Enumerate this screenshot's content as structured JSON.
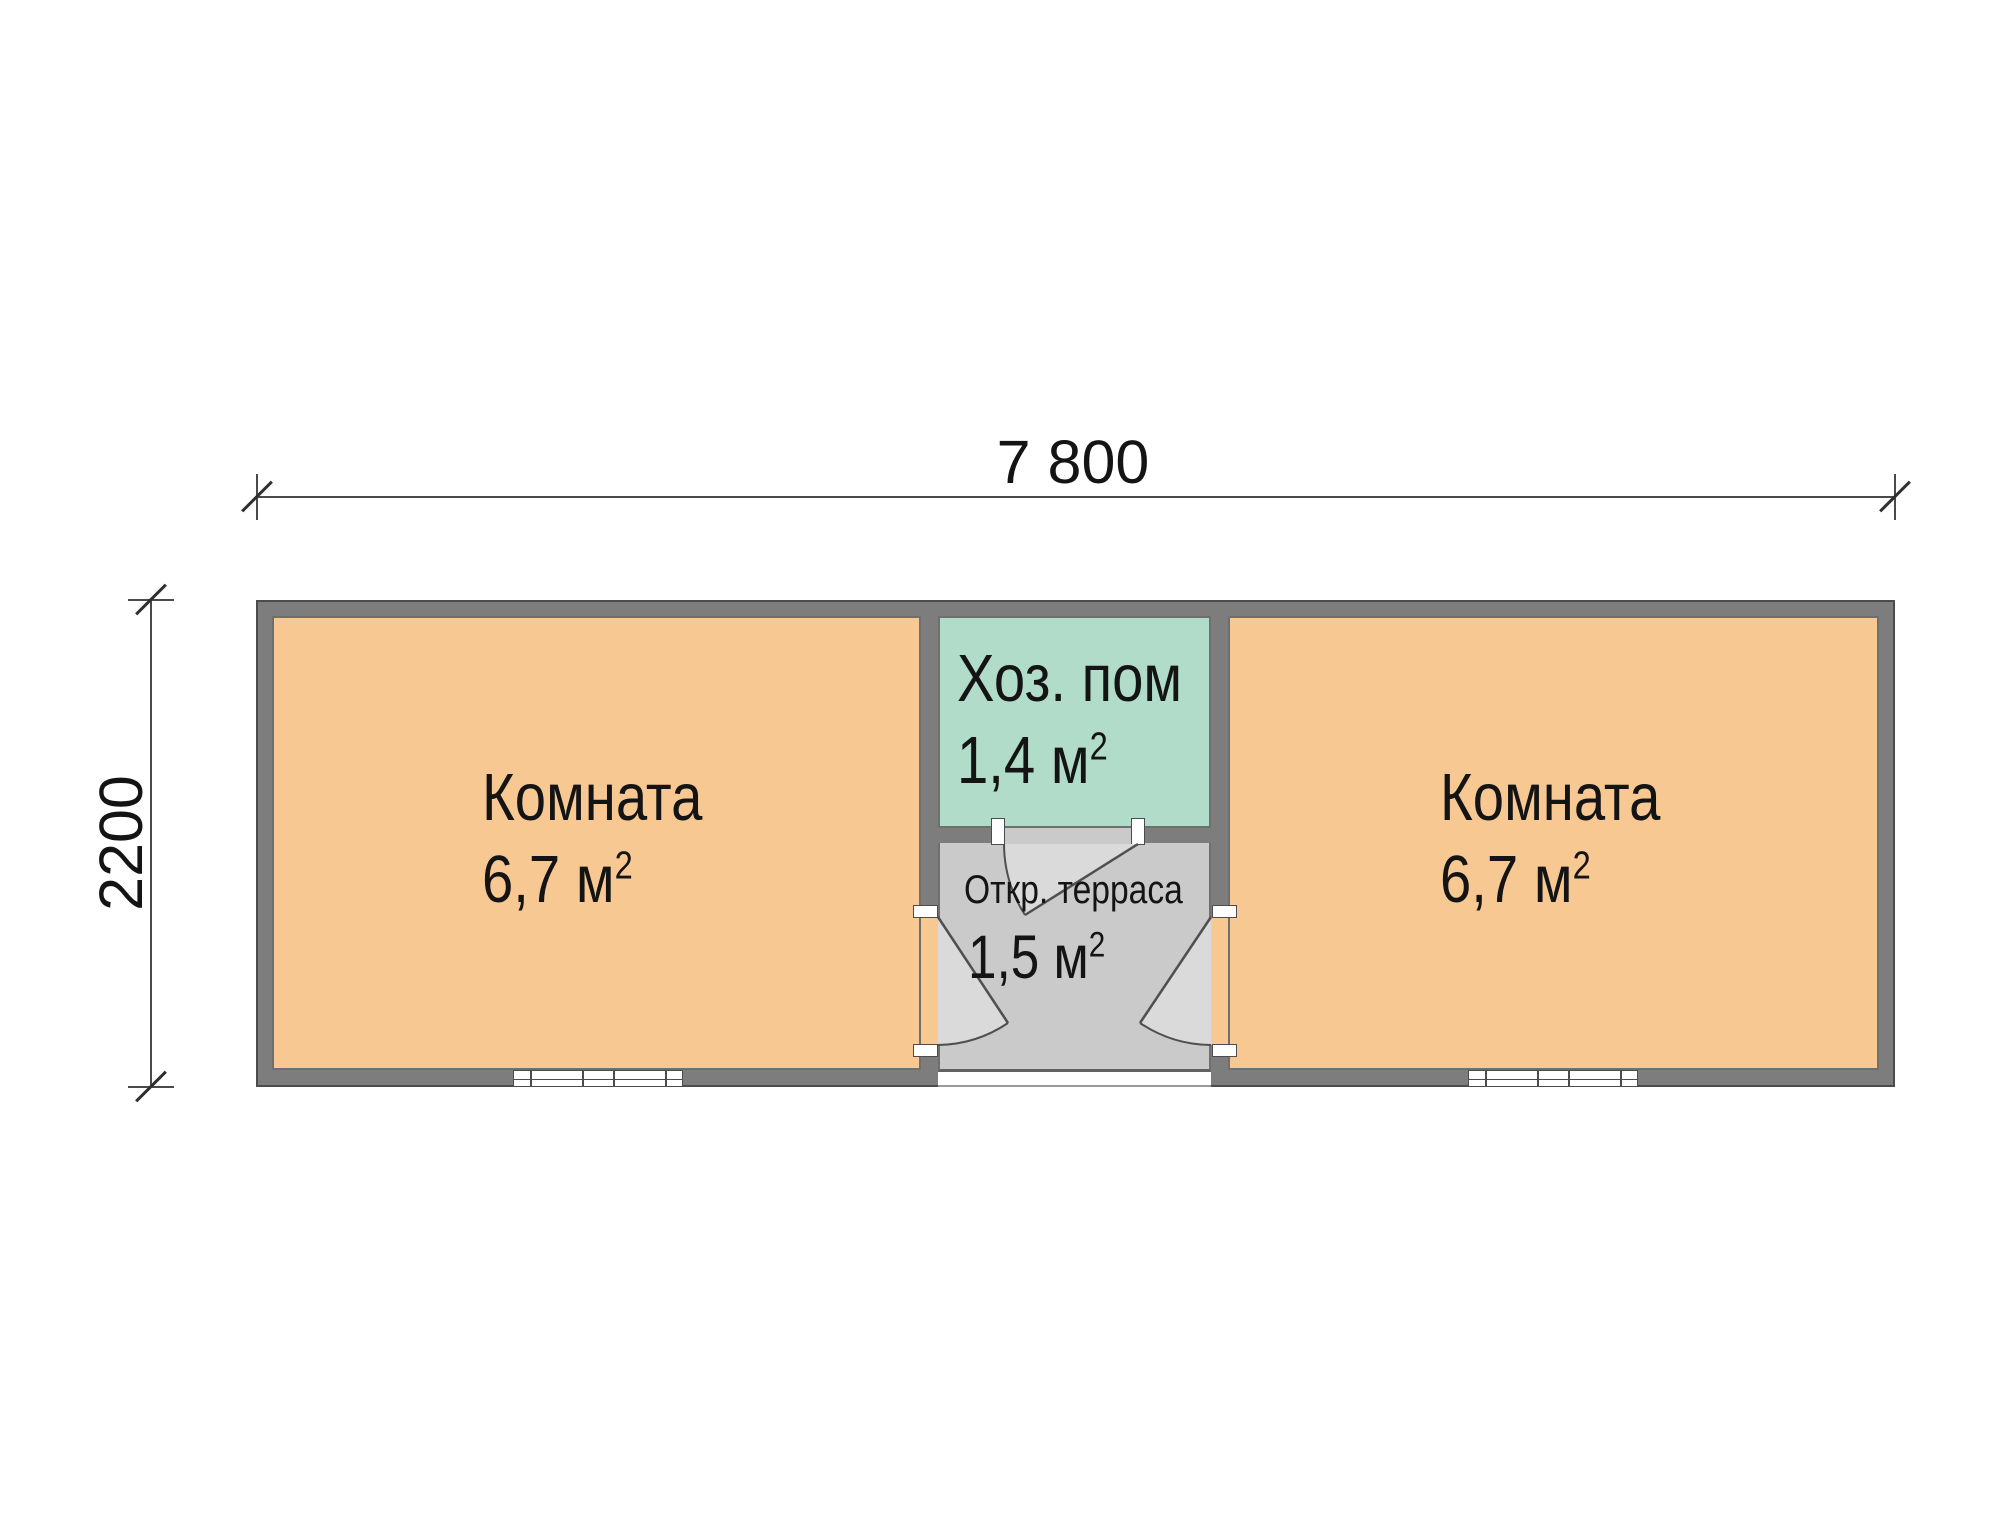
{
  "plan": {
    "dimensions": {
      "width_label": "7 800",
      "height_label": "2200"
    },
    "rooms": {
      "left": {
        "name": "Комната",
        "area": "6,7 м",
        "sup": "2"
      },
      "right": {
        "name": "Комната",
        "area": "6,7 м",
        "sup": "2"
      },
      "utility": {
        "name": "Хоз. пом",
        "area": "1,4 м",
        "sup": "2"
      },
      "terrace": {
        "name": "Откр. терраса",
        "area": "1,5 м",
        "sup": "2"
      }
    }
  },
  "colors": {
    "wall": "#7d7d7d",
    "wall_outline": "#4c4c4c",
    "room_fill": "#f8c893",
    "utility_fill": "#b2dcca",
    "terrace_fill": "#cacaca",
    "swing_fill": "#dadada",
    "line": "#4a4a4a",
    "text": "#141414"
  }
}
